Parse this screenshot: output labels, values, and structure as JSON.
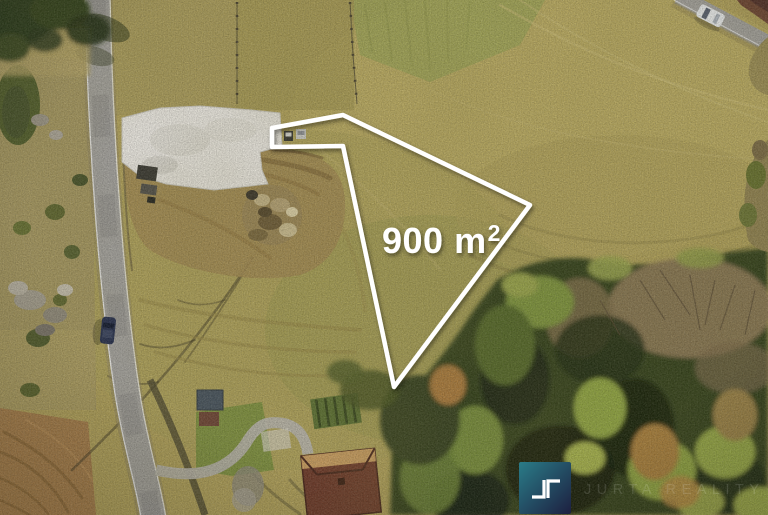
{
  "overlay": {
    "area_label": "900 m",
    "area_superscript": "2",
    "area_full_text": "900 m²",
    "outline_color": "#ffffff"
  },
  "branding": {
    "watermark_text": "JURTA REALITY",
    "logo_icon": "corner-brackets-monogram",
    "logo_gradient_start": "#2a7c88",
    "logo_gradient_end": "#1d1f40"
  }
}
